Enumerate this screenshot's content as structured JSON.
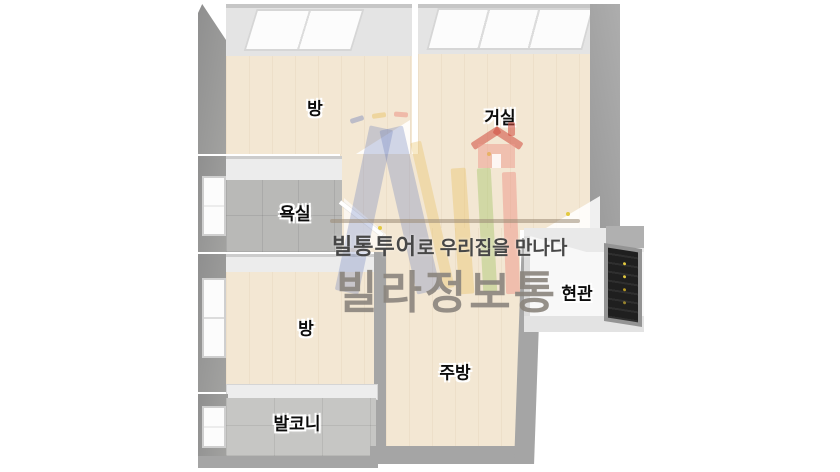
{
  "floorplan": {
    "title": "villa-floorplan",
    "rooms": [
      {
        "name": "bedroom-top-left",
        "label": "방"
      },
      {
        "name": "living-room",
        "label": "거실"
      },
      {
        "name": "bathroom",
        "label": "욕실"
      },
      {
        "name": "bedroom-middle-left",
        "label": "방"
      },
      {
        "name": "balcony",
        "label": "발코니"
      },
      {
        "name": "kitchen",
        "label": "주방"
      },
      {
        "name": "entrance",
        "label": "현관"
      }
    ]
  },
  "watermark": {
    "tagline_brand": "빌통투어",
    "tagline_rest": "로 우리집을 만나다",
    "brand_name": "빌라정보통"
  },
  "colors": {
    "floor_wood": "#f3e7d3",
    "tile_gray": "#b9b9b7",
    "balcony_tile": "#c6c6c4",
    "wall_gray": "#a5a5a5",
    "wall_dark": "#8f8f8f",
    "wall_face": "#e4e4e4",
    "window_white": "#fcfcfc",
    "door_dark": "#1f1f1f",
    "door_dot_yellow": "#e3c93f",
    "divider_line": "#9a8a74",
    "tagline_text": "#474747",
    "brand_text": "#8b857e",
    "wm_blue": "#687cba",
    "wm_yellow": "#e9bf5e",
    "wm_green": "#9ec462",
    "wm_pink": "#ec8276",
    "wm_roof_red": "#cf4a3c",
    "wm_house_pink": "#ee9a8c"
  }
}
